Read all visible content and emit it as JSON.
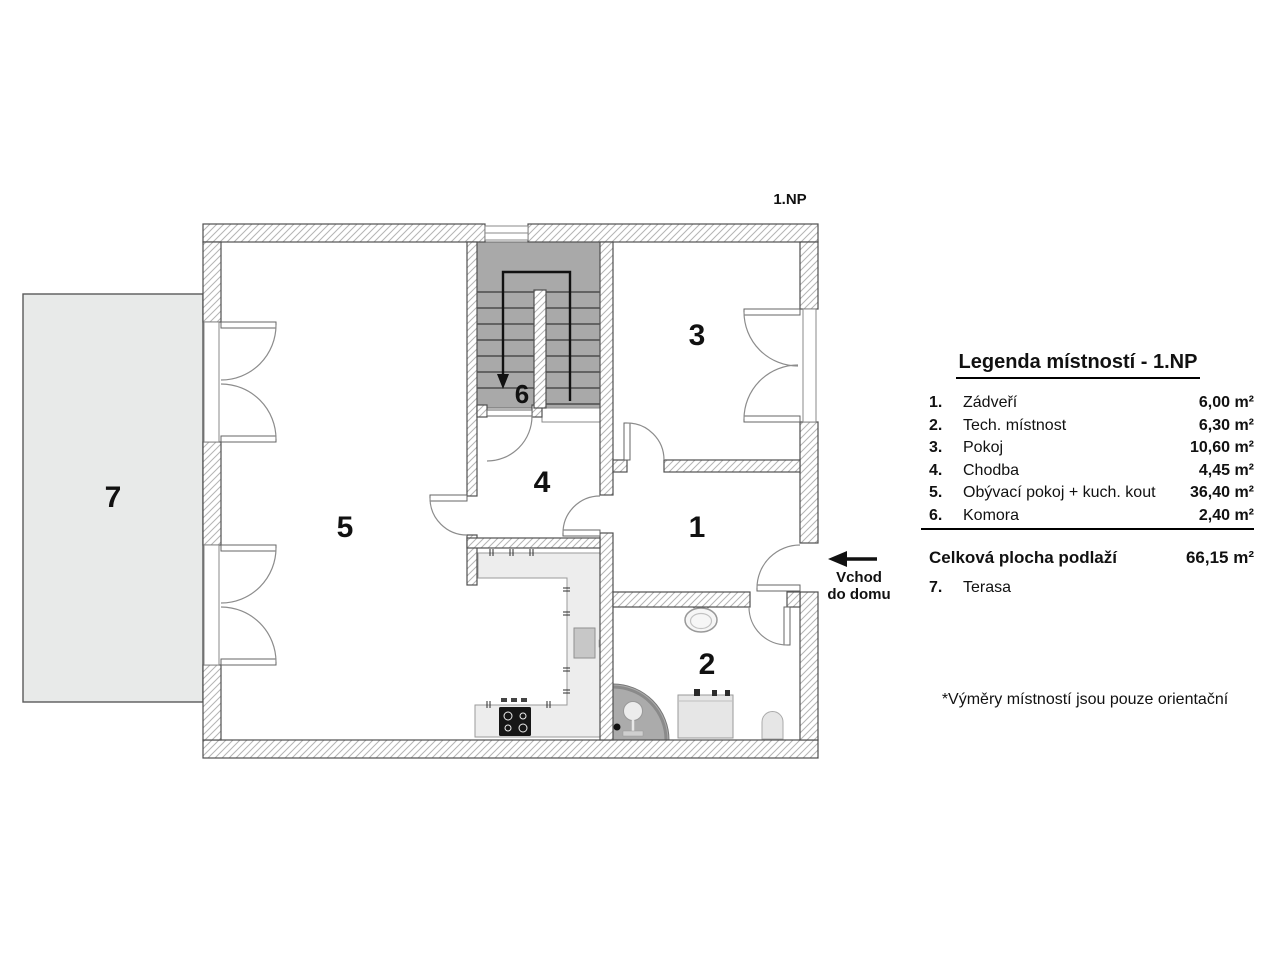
{
  "floor_label": "1.NP",
  "plan": {
    "room_numbers": [
      "1",
      "2",
      "3",
      "4",
      "5",
      "6",
      "7"
    ],
    "entrance_arrow_label": {
      "line1": "Vchod",
      "line2": "do domu"
    }
  },
  "legend": {
    "title": "Legenda místností - 1.NP",
    "rows": [
      {
        "num": "1.",
        "name": "Zádveří",
        "area": "6,00 m²"
      },
      {
        "num": "2.",
        "name": "Tech. místnost",
        "area": "6,30 m²"
      },
      {
        "num": "3.",
        "name": "Pokoj",
        "area": "10,60 m²"
      },
      {
        "num": "4.",
        "name": "Chodba",
        "area": "4,45 m²"
      },
      {
        "num": "5.",
        "name": "Obývací pokoj + kuch. kout",
        "area": "36,40 m²"
      },
      {
        "num": "6.",
        "name": "Komora",
        "area": "2,40 m²"
      }
    ],
    "total": {
      "label": "Celková plocha podlaží",
      "area": "66,15 m²"
    },
    "terrace_row": {
      "num": "7.",
      "name": "Terasa"
    }
  },
  "footnote": "*Výměry místností jsou pouze orientační",
  "colors": {
    "wall-line": "#4f4f4f",
    "hatch-line": "#b4b4b4",
    "door-line": "#8c8c8c",
    "stair-fill": "#a9a9a9",
    "terrace-fill": "#e8eae9",
    "counter-fill": "#ededed",
    "text": "#111111"
  }
}
